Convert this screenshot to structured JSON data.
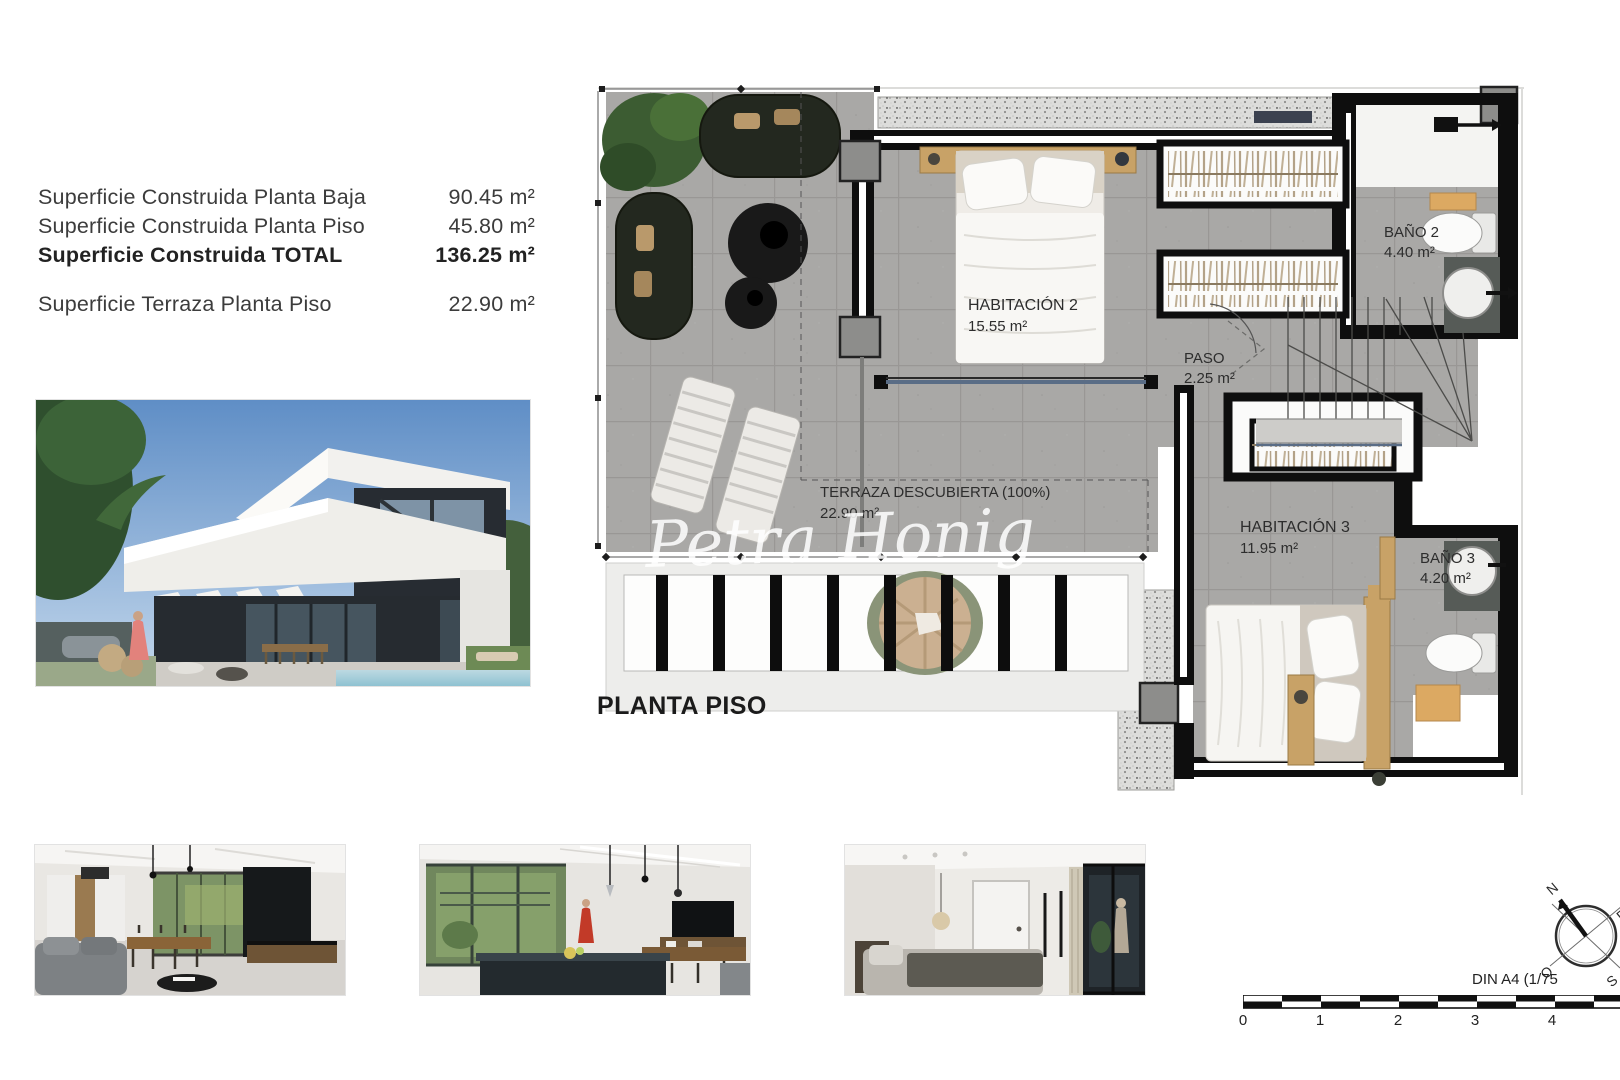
{
  "summary": {
    "rows": [
      {
        "label": "Superficie Construida Planta Baja",
        "value": "90.45 m²"
      },
      {
        "label": "Superficie Construida Planta Piso",
        "value": "45.80 m²"
      },
      {
        "label": "Superficie Construida TOTAL",
        "value": "136.25 m²"
      },
      {
        "label": "Superficie Terraza Planta Piso",
        "value": "22.90 m²"
      }
    ]
  },
  "floor_plan": {
    "title": "PLANTA PISO",
    "watermark": "Petra Honig",
    "rooms": [
      {
        "name": "HABITACIÓN 2",
        "area": "15.55 m²"
      },
      {
        "name": "PASO",
        "area": "2.25 m²"
      },
      {
        "name": "BAÑO 2",
        "area": "4.40 m²"
      },
      {
        "name": "HABITACIÓN 3",
        "area": "11.95 m²"
      },
      {
        "name": "BAÑO 3",
        "area": "4.20 m²"
      },
      {
        "name": "TERRAZA DESCUBIERTA (100%)",
        "area": "22.90 m²"
      }
    ]
  },
  "scale_bar": {
    "label": "DIN A4 (1/75",
    "ticks": [
      "0",
      "1",
      "2",
      "3",
      "4"
    ]
  },
  "compass": {
    "n": "N",
    "e": "E",
    "s": "S",
    "o": "O"
  },
  "colors": {
    "wall": "#0e0e0e",
    "floor": "#a9a8a6",
    "wood": "#c8a267",
    "accent_glass": "#5a6d86"
  }
}
